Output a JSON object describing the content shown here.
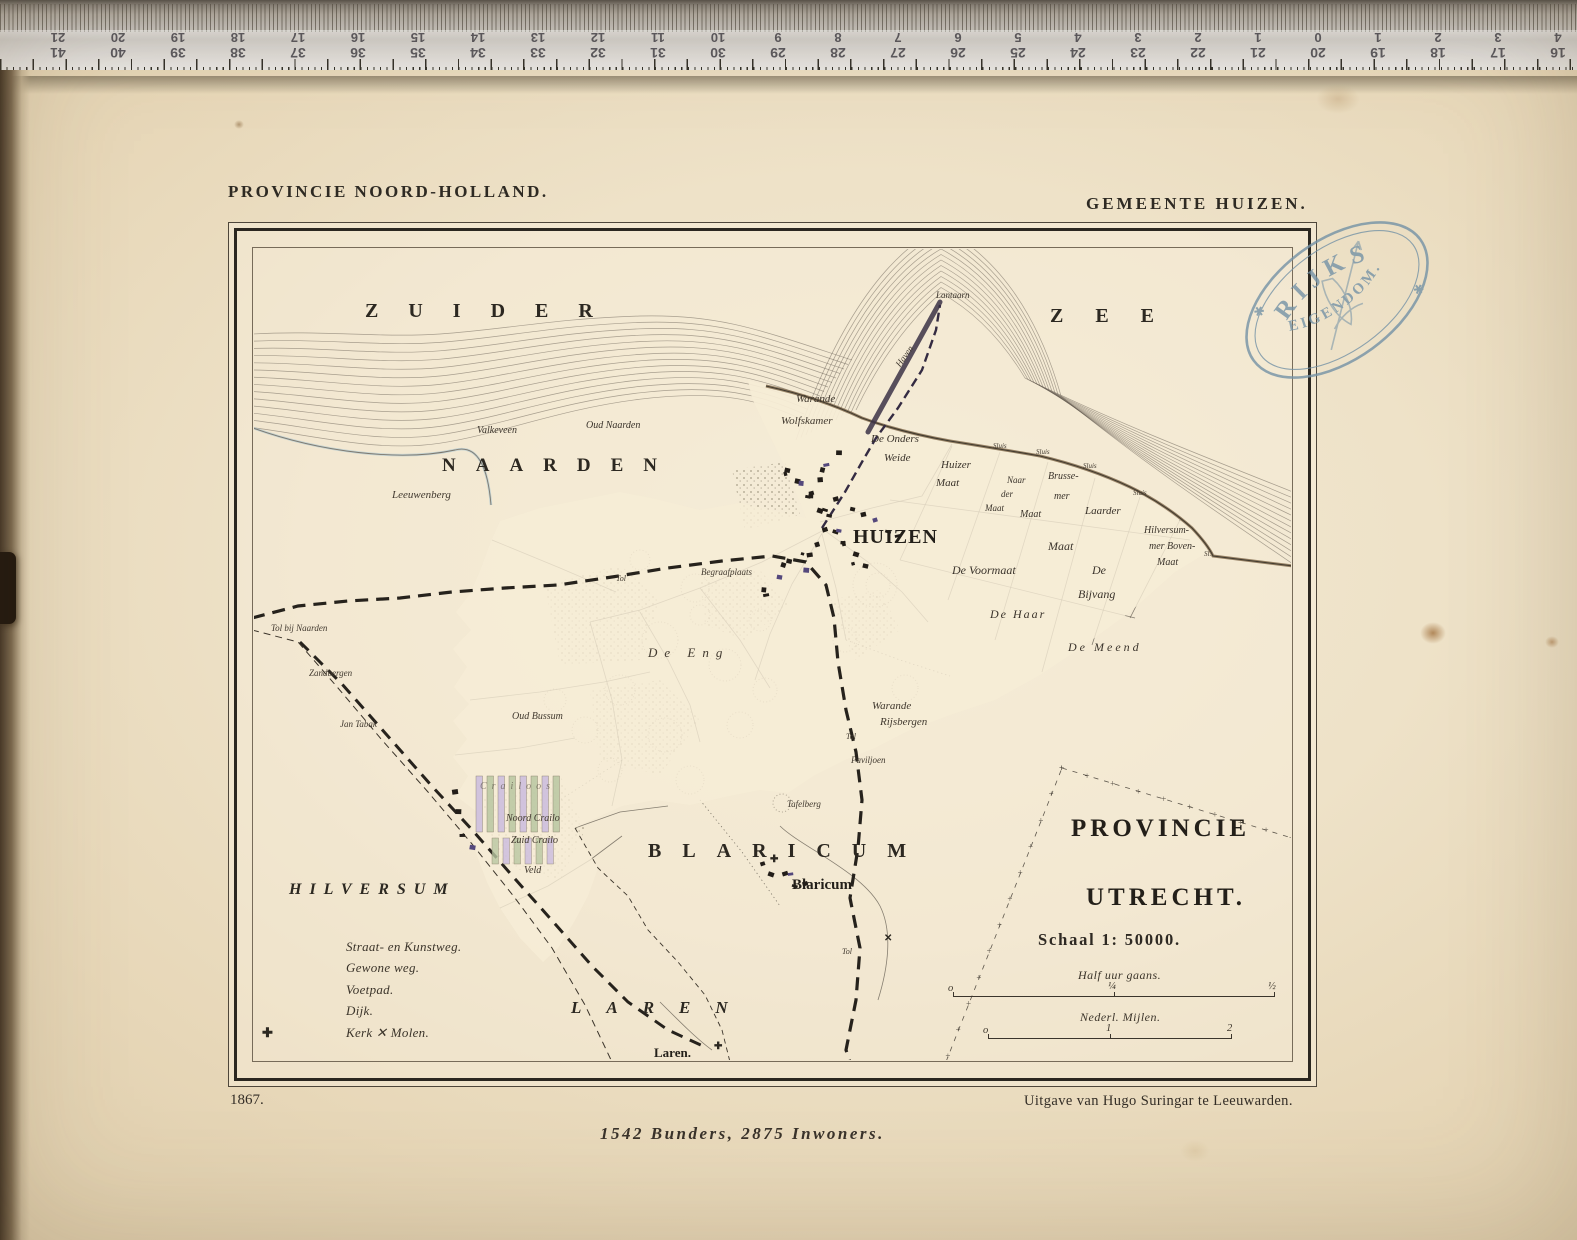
{
  "header": {
    "left": "PROVINCIE NOORD-HOLLAND.",
    "right": "GEMEENTE HUIZEN."
  },
  "stamp": {
    "line1": "RIJKS",
    "line2": "EIGENDOM.",
    "star": "✱"
  },
  "footer": {
    "year": "1867.",
    "publisher": "Uitgave van Hugo Suringar te Leeuwarden.",
    "stats": "1542 Bunders, 2875 Inwoners."
  },
  "scale": {
    "title": "Schaal 1: 50000.",
    "bar1_label": "Half uur gaans.",
    "bar1_ticks": [
      "o",
      "¼",
      "½"
    ],
    "bar2_label": "Nederl. Mijlen.",
    "bar2_ticks": [
      "o",
      "1",
      "2"
    ]
  },
  "legend": {
    "items": [
      {
        "sym": "straat",
        "label": "Straat- en Kunstweg."
      },
      {
        "sym": "gewone",
        "label": "Gewone weg."
      },
      {
        "sym": "voetpad",
        "label": "Voetpad."
      },
      {
        "sym": "dijk",
        "label": "Dijk."
      },
      {
        "sym": "kerk",
        "label": "Kerk  ✕  Molen."
      }
    ],
    "kerk_symbol": "✚"
  },
  "ruler": {
    "pairs": [
      {
        "top": "21",
        "bottom": "41"
      },
      {
        "top": "20",
        "bottom": "40"
      },
      {
        "top": "19",
        "bottom": "39"
      },
      {
        "top": "18",
        "bottom": "38"
      },
      {
        "top": "17",
        "bottom": "37"
      },
      {
        "top": "16",
        "bottom": "36"
      },
      {
        "top": "15",
        "bottom": "35"
      },
      {
        "top": "14",
        "bottom": "34"
      },
      {
        "top": "13",
        "bottom": "33"
      },
      {
        "top": "12",
        "bottom": "32"
      },
      {
        "top": "11",
        "bottom": "31"
      },
      {
        "top": "10",
        "bottom": "30"
      },
      {
        "top": "9",
        "bottom": "29"
      },
      {
        "top": "8",
        "bottom": "28"
      },
      {
        "top": "7",
        "bottom": "27"
      },
      {
        "top": "6",
        "bottom": "26"
      },
      {
        "top": "5",
        "bottom": "25"
      },
      {
        "top": "4",
        "bottom": "24"
      },
      {
        "top": "3",
        "bottom": "23"
      },
      {
        "top": "2",
        "bottom": "22"
      },
      {
        "top": "1",
        "bottom": "21"
      },
      {
        "top": "0",
        "bottom": "20"
      },
      {
        "top": "1",
        "bottom": "19"
      },
      {
        "top": "2",
        "bottom": "18"
      },
      {
        "top": "3",
        "bottom": "17"
      },
      {
        "top": "4",
        "bottom": "16"
      }
    ]
  },
  "colors": {
    "paper": "#eee2c8",
    "ink": "#332d26",
    "boundary_yellow": "#e3bd6d",
    "boundary_blue": "#8fb3c4",
    "stamp_blue": "#7492a6"
  },
  "map": {
    "labels": [
      {
        "t": "ZUIDER",
        "x": 365,
        "y": 301,
        "fs": 20,
        "ls": 30,
        "cls": "caps"
      },
      {
        "t": "ZEE",
        "x": 1050,
        "y": 306,
        "fs": 20,
        "ls": 32,
        "cls": "caps"
      },
      {
        "t": "NAARDEN",
        "x": 442,
        "y": 456,
        "fs": 19,
        "ls": 20,
        "cls": "caps"
      },
      {
        "t": "BLARICUM",
        "x": 648,
        "y": 841,
        "fs": 20,
        "ls": 21,
        "cls": "caps"
      },
      {
        "t": "HILVERSUM",
        "x": 289,
        "y": 882,
        "fs": 16,
        "ls": 8,
        "cls": "capsI"
      },
      {
        "t": "LAREN",
        "x": 571,
        "y": 999,
        "fs": 17,
        "ls": 25,
        "cls": "capsI"
      },
      {
        "t": "PROVINCIE",
        "x": 1071,
        "y": 816,
        "fs": 25,
        "ls": 4,
        "cls": "big"
      },
      {
        "t": "UTRECHT.",
        "x": 1086,
        "y": 885,
        "fs": 25,
        "ls": 4,
        "cls": "big"
      },
      {
        "t": "HUIZEN",
        "x": 853,
        "y": 527,
        "fs": 20,
        "ls": 1,
        "cls": "big"
      },
      {
        "t": "Blaricum",
        "x": 792,
        "y": 878,
        "fs": 15,
        "cls": "town"
      },
      {
        "t": "Laren.",
        "x": 654,
        "y": 1046,
        "fs": 13,
        "cls": "town"
      },
      {
        "t": "Lantaarn",
        "x": 936,
        "y": 291,
        "fs": 9,
        "cls": "pl"
      },
      {
        "t": "Valkeveen",
        "x": 477,
        "y": 426,
        "fs": 10,
        "cls": "pl"
      },
      {
        "t": "Oud Naarden",
        "x": 586,
        "y": 421,
        "fs": 10,
        "cls": "pl"
      },
      {
        "t": "Leeuwenberg",
        "x": 392,
        "y": 490,
        "fs": 11,
        "cls": "scr"
      },
      {
        "t": "Warande",
        "x": 796,
        "y": 394,
        "fs": 11,
        "cls": "scr"
      },
      {
        "t": "Wolfskamer",
        "x": 781,
        "y": 416,
        "fs": 11,
        "cls": "scr"
      },
      {
        "t": "De Onders",
        "x": 871,
        "y": 434,
        "fs": 11,
        "cls": "pl"
      },
      {
        "t": "Weide",
        "x": 884,
        "y": 453,
        "fs": 11,
        "cls": "pl"
      },
      {
        "t": "Huizer",
        "x": 941,
        "y": 460,
        "fs": 11,
        "cls": "pl"
      },
      {
        "t": "Maat",
        "x": 936,
        "y": 478,
        "fs": 11,
        "cls": "pl"
      },
      {
        "t": "Naar",
        "x": 1007,
        "y": 476,
        "fs": 9,
        "cls": "pl"
      },
      {
        "t": "der",
        "x": 1001,
        "y": 490,
        "fs": 9,
        "cls": "pl"
      },
      {
        "t": "Maat",
        "x": 985,
        "y": 504,
        "fs": 9,
        "cls": "pl"
      },
      {
        "t": "Brusse-",
        "x": 1048,
        "y": 472,
        "fs": 10,
        "cls": "pl"
      },
      {
        "t": "mer",
        "x": 1054,
        "y": 492,
        "fs": 10,
        "cls": "pl"
      },
      {
        "t": "Maat",
        "x": 1020,
        "y": 510,
        "fs": 10,
        "cls": "pl"
      },
      {
        "t": "Laarder",
        "x": 1085,
        "y": 506,
        "fs": 11,
        "cls": "pl"
      },
      {
        "t": "Maat",
        "x": 1048,
        "y": 540,
        "fs": 12,
        "cls": "pl"
      },
      {
        "t": "Hilversum-",
        "x": 1144,
        "y": 526,
        "fs": 10,
        "cls": "pl"
      },
      {
        "t": "mer Boven-",
        "x": 1149,
        "y": 542,
        "fs": 10,
        "cls": "pl"
      },
      {
        "t": "Maat",
        "x": 1157,
        "y": 558,
        "fs": 10,
        "cls": "pl"
      },
      {
        "t": "De Voormaat",
        "x": 952,
        "y": 564,
        "fs": 12,
        "cls": "pl"
      },
      {
        "t": "De Haar",
        "x": 990,
        "y": 608,
        "fs": 12,
        "ls": 2,
        "cls": "pl"
      },
      {
        "t": "De",
        "x": 1092,
        "y": 564,
        "fs": 12,
        "cls": "pl"
      },
      {
        "t": "Bijvang",
        "x": 1078,
        "y": 588,
        "fs": 12,
        "cls": "pl"
      },
      {
        "t": "De Meend",
        "x": 1068,
        "y": 641,
        "fs": 12,
        "ls": 3,
        "cls": "pl"
      },
      {
        "t": "Warande",
        "x": 872,
        "y": 701,
        "fs": 11,
        "cls": "scr"
      },
      {
        "t": "Rijsbergen",
        "x": 880,
        "y": 717,
        "fs": 11,
        "cls": "scr"
      },
      {
        "t": "Paviljoen",
        "x": 851,
        "y": 756,
        "fs": 9,
        "cls": "scr"
      },
      {
        "t": "Tafelberg",
        "x": 787,
        "y": 800,
        "fs": 9,
        "cls": "scr"
      },
      {
        "t": "De Eng",
        "x": 648,
        "y": 646,
        "fs": 13,
        "ls": 7,
        "cls": "scr"
      },
      {
        "t": "Begraafplaats",
        "x": 701,
        "y": 568,
        "fs": 9,
        "cls": "scr"
      },
      {
        "t": "Oud Bussum",
        "x": 512,
        "y": 712,
        "fs": 10,
        "cls": "scr"
      },
      {
        "t": "Noord Crailo",
        "x": 506,
        "y": 814,
        "fs": 10,
        "cls": "scr"
      },
      {
        "t": "Zuid Crailo",
        "x": 511,
        "y": 836,
        "fs": 10,
        "cls": "scr"
      },
      {
        "t": "Veld",
        "x": 524,
        "y": 866,
        "fs": 10,
        "cls": "scr"
      },
      {
        "t": "Tol bij Naarden",
        "x": 271,
        "y": 624,
        "fs": 9,
        "cls": "scr"
      },
      {
        "t": "Zandbergen",
        "x": 309,
        "y": 669,
        "fs": 9,
        "cls": "scr"
      },
      {
        "t": "Jan Tabak",
        "x": 340,
        "y": 720,
        "fs": 9,
        "cls": "scr"
      },
      {
        "t": "Tol",
        "x": 616,
        "y": 575,
        "fs": 8,
        "cls": "scr"
      },
      {
        "t": "Tol",
        "x": 846,
        "y": 733,
        "fs": 8,
        "cls": "scr"
      },
      {
        "t": "Tol",
        "x": 842,
        "y": 948,
        "fs": 8,
        "cls": "scr"
      },
      {
        "t": "Sluis",
        "x": 993,
        "y": 443,
        "fs": 7,
        "cls": "tiny"
      },
      {
        "t": "Sluis",
        "x": 1036,
        "y": 449,
        "fs": 7,
        "cls": "tiny"
      },
      {
        "t": "Sluis",
        "x": 1083,
        "y": 463,
        "fs": 7,
        "cls": "tiny"
      },
      {
        "t": "Sluis",
        "x": 1133,
        "y": 490,
        "fs": 7,
        "cls": "tiny"
      },
      {
        "t": "Sl.",
        "x": 1204,
        "y": 551,
        "fs": 7,
        "cls": "tiny"
      },
      {
        "t": "Haven",
        "x": 893,
        "y": 352,
        "fs": 9,
        "cls": "scr",
        "rot": -55
      },
      {
        "t": "Crailoos",
        "x": 480,
        "y": 782,
        "fs": 10,
        "ls": 5,
        "cls": "scr",
        "op": 0.55
      },
      {
        "t": "✚",
        "x": 770,
        "y": 855,
        "fs": 10,
        "cls": "sym"
      },
      {
        "t": "✚",
        "x": 714,
        "y": 1042,
        "fs": 10,
        "cls": "sym"
      },
      {
        "t": "✕",
        "x": 884,
        "y": 934,
        "fs": 10,
        "cls": "sym"
      }
    ]
  }
}
